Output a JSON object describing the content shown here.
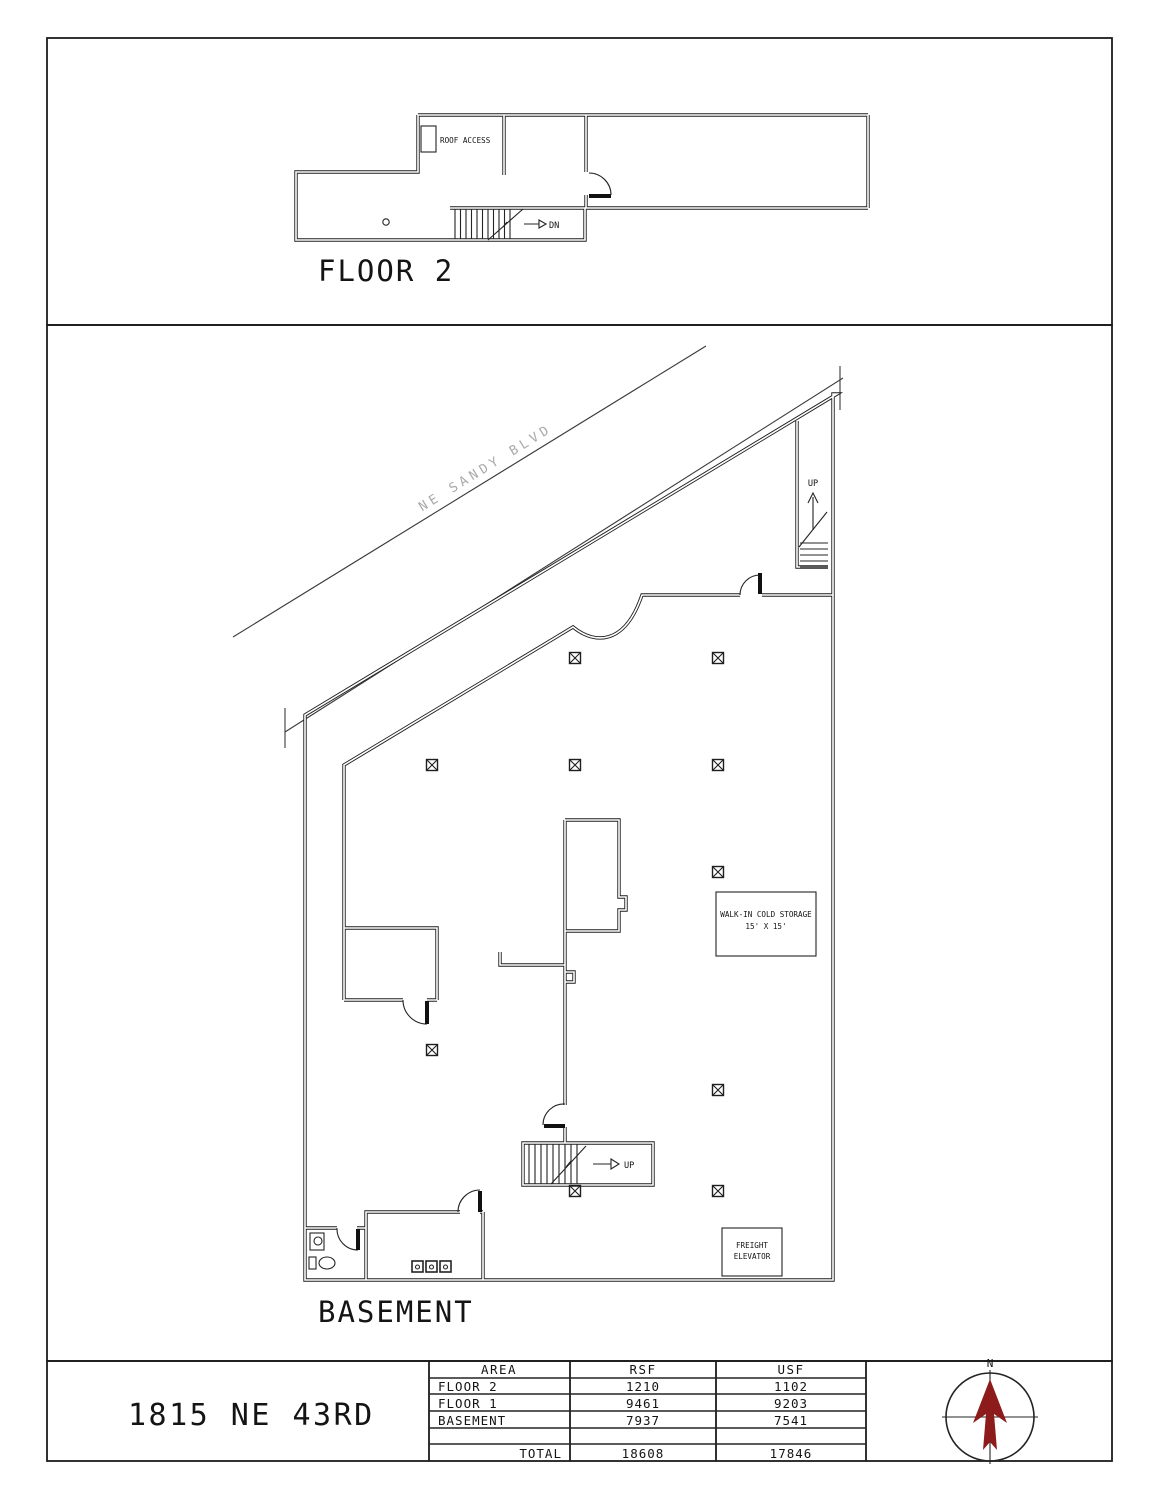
{
  "floor2": {
    "label": "FLOOR 2",
    "roof_access": "ROOF ACCESS",
    "dn": "DN"
  },
  "basement": {
    "label": "BASEMENT",
    "street": "NE SANDY BLVD",
    "up_top": "UP",
    "up_center": "UP",
    "cold_line1": "WALK-IN COLD STORAGE",
    "cold_line2": "15' X 15'",
    "freight_line1": "FREIGHT",
    "freight_line2": "ELEVATOR"
  },
  "title_block": {
    "address": "1815 NE 43RD",
    "compass_n": "N",
    "compass_color": "#8e1b1b",
    "table": {
      "headers": [
        "AREA",
        "RSF",
        "USF"
      ],
      "rows": [
        {
          "area": "FLOOR 2",
          "rsf": "1210",
          "usf": "1102"
        },
        {
          "area": "FLOOR 1",
          "rsf": "9461",
          "usf": "9203"
        },
        {
          "area": "BASEMENT",
          "rsf": "7937",
          "usf": "7541"
        }
      ],
      "total_label": "TOTAL",
      "total_rsf": "18608",
      "total_usf": "17846"
    }
  }
}
